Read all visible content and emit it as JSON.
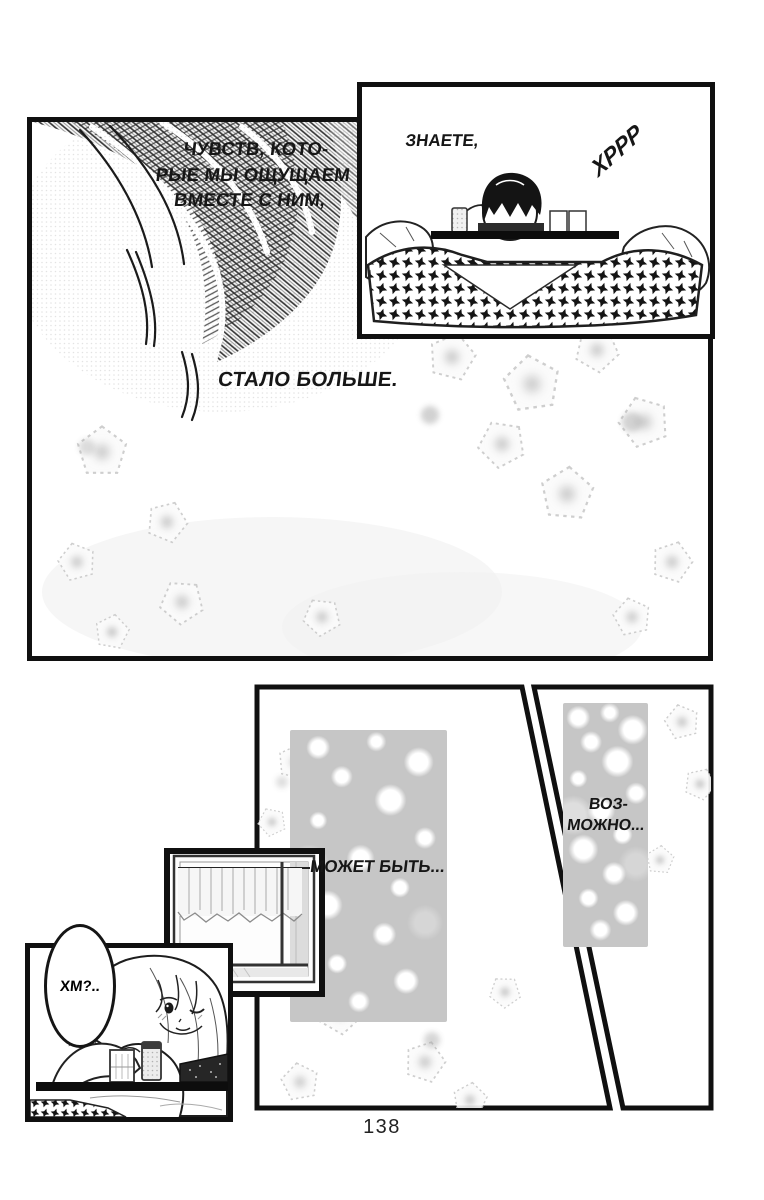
{
  "page": {
    "number": "138",
    "paper_color": "#ffffff",
    "ink_color": "#111111"
  },
  "panels": {
    "memory": {
      "narration": [
        "ЧУВСТВ, КОТО-",
        "РЫЕ МЫ ОЩУЩАЕМ",
        "ВМЕСТЕ С НИМ,"
      ],
      "caption": "СТАЛО БОЛЬШЕ."
    },
    "kotatsu": {
      "speech": "ЗНАЕТЕ,",
      "sfx": "ХРРР"
    },
    "maybe": {
      "caption": "МОЖЕТ БЫТЬ..."
    },
    "possibly": {
      "caption_lines": [
        "ВОЗ-",
        "МОЖНО..."
      ]
    },
    "girl": {
      "bubble": "ХМ?.."
    }
  }
}
